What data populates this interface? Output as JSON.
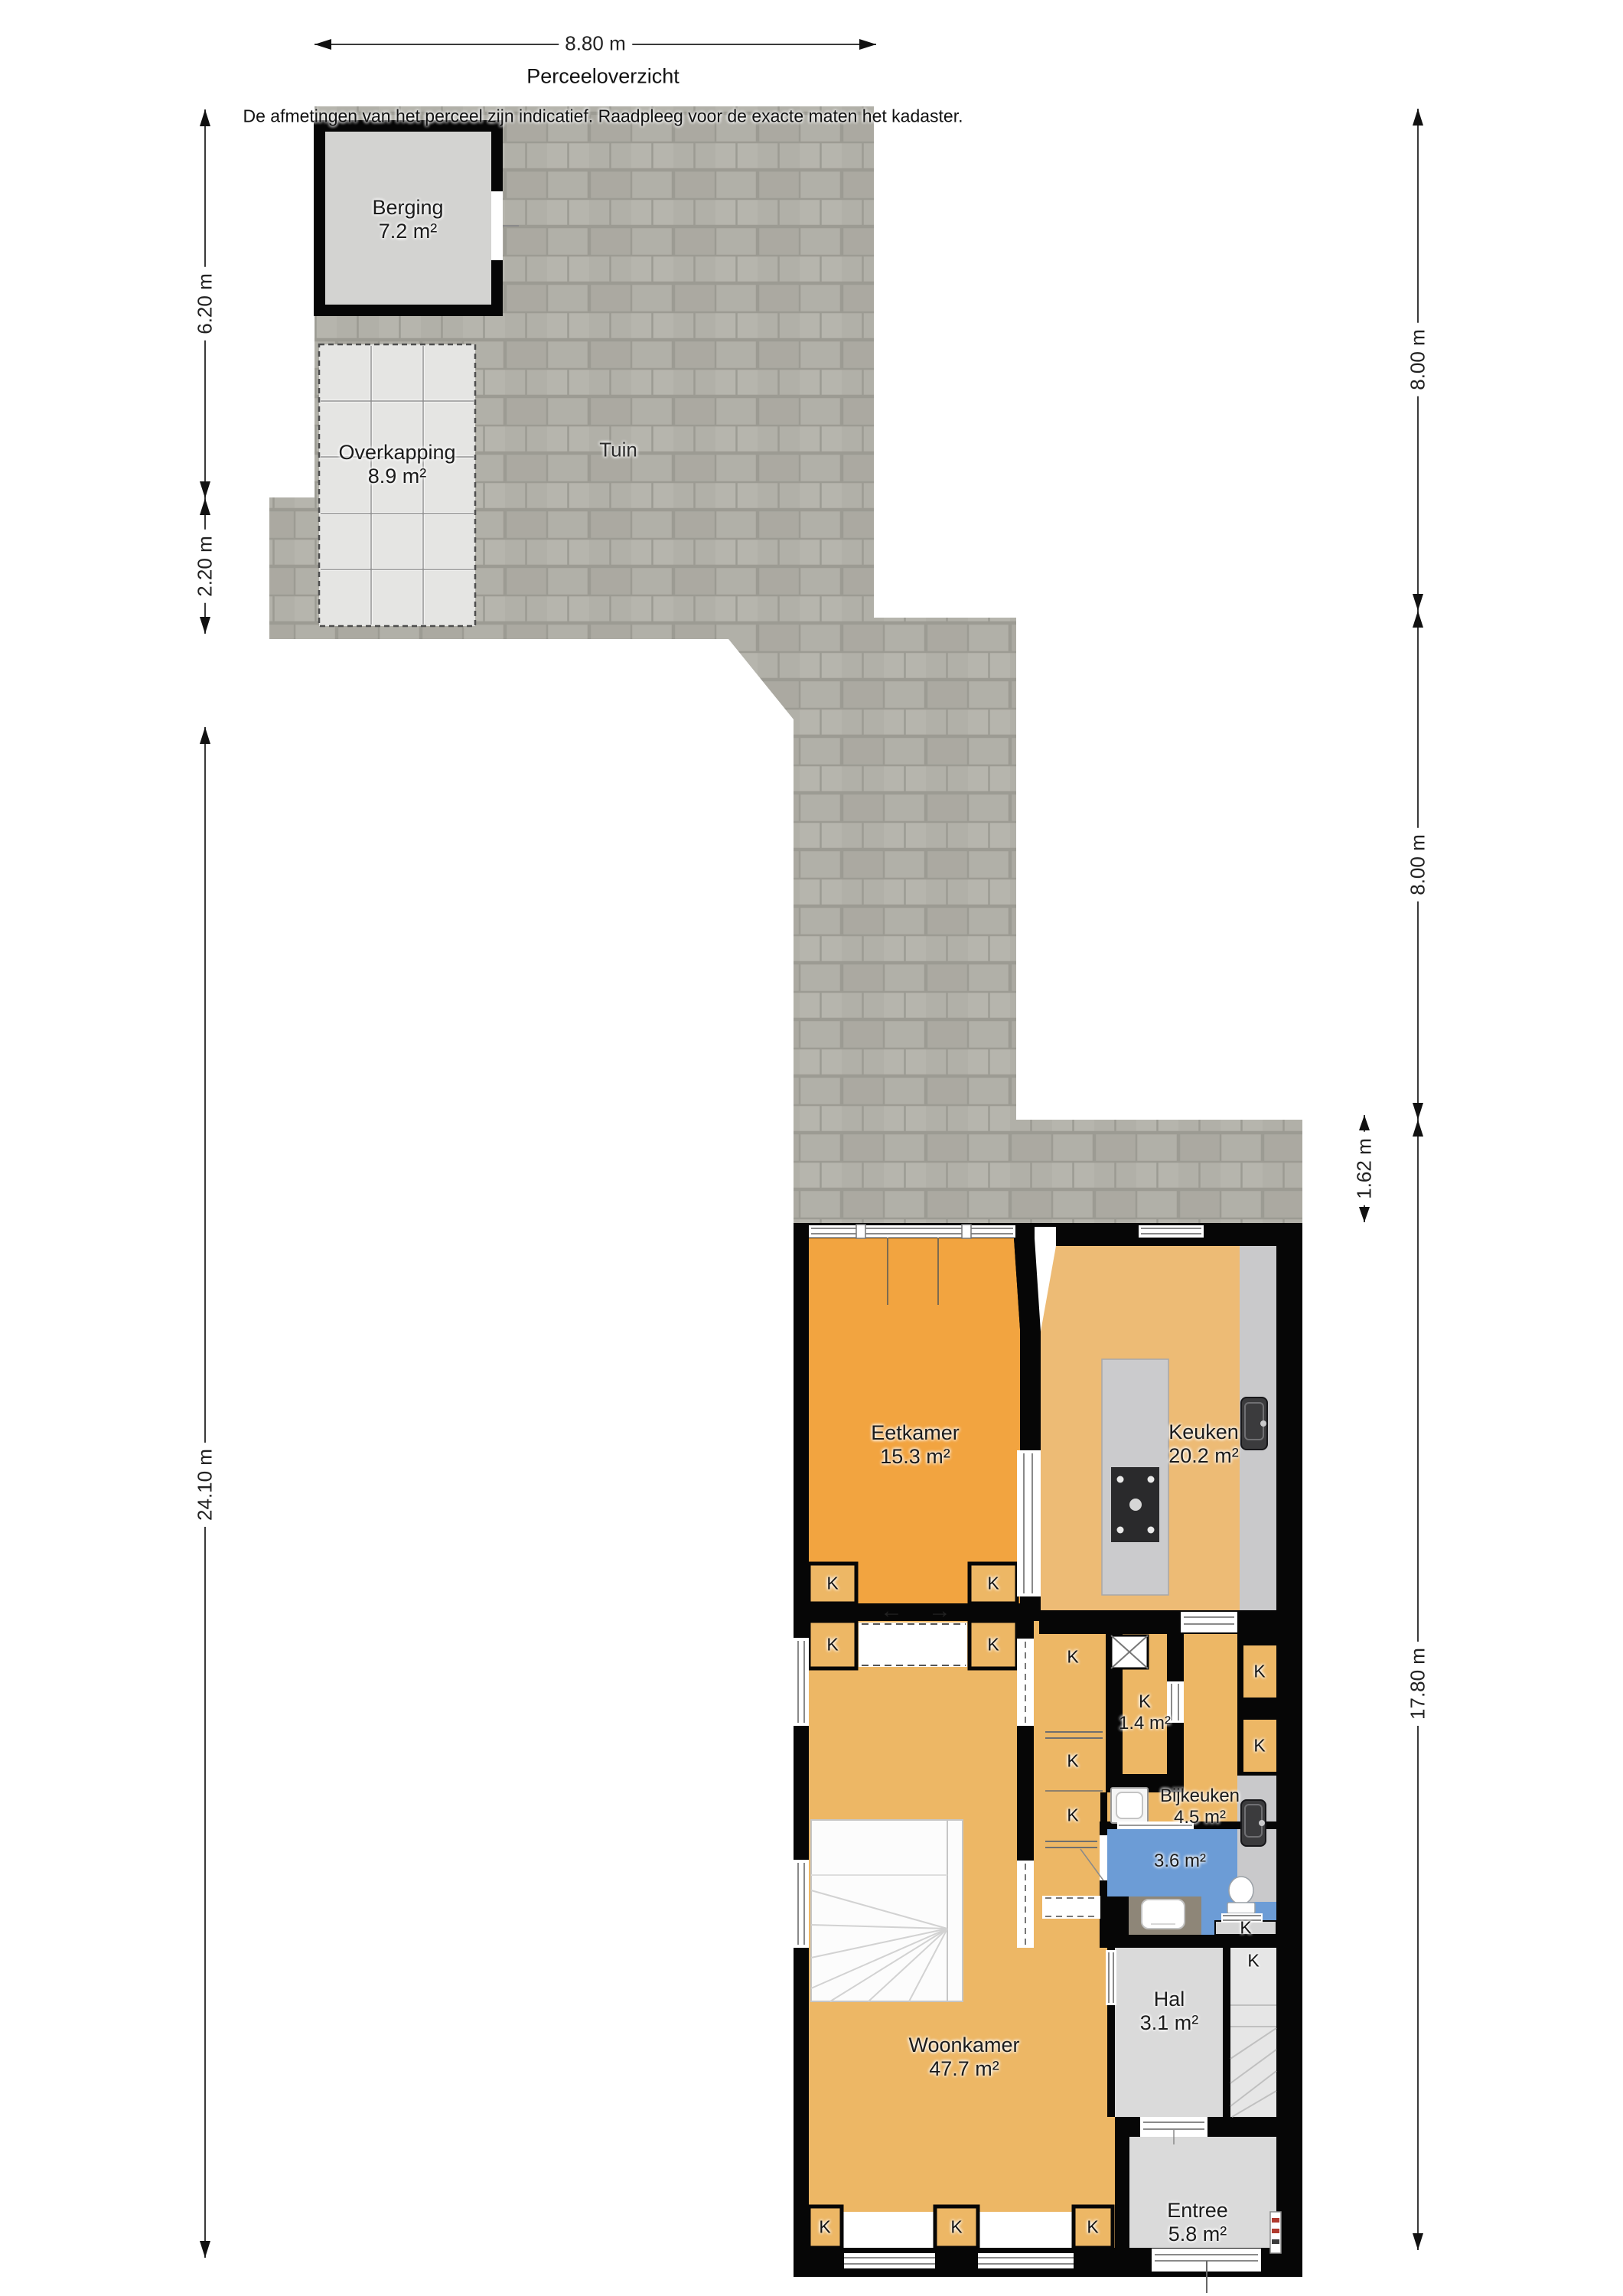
{
  "header": {
    "dimension_top": "8.80 m",
    "title": "Perceeloverzicht",
    "disclaimer": "De afmetingen van het perceel zijn indicatief. Raadpleeg voor de exacte maten het kadaster."
  },
  "dimensions": {
    "left_upper": "6.20 m",
    "left_lower": "2.20 m",
    "left_total": "24.10 m",
    "right_upper": "8.00 m",
    "right_middle": "8.00 m",
    "right_strip": "1.62 m",
    "right_house": "17.80 m"
  },
  "garden": {
    "label": "Tuin",
    "berging_name": "Berging",
    "berging_area": "7.2 m²",
    "overkapping_name": "Overkapping",
    "overkapping_area": "8.9 m²"
  },
  "rooms": {
    "eetkamer_name": "Eetkamer",
    "eetkamer_area": "15.3 m²",
    "keuken_name": "Keuken",
    "keuken_area": "20.2 m²",
    "kast_name": "K",
    "kast_area": "1.4 m²",
    "bijkeuken_name": "Bijkeuken",
    "bijkeuken_area": "4.5 m²",
    "toilet_area": "3.6 m²",
    "hal_name": "Hal",
    "hal_area": "3.1 m²",
    "woonkamer_name": "Woonkamer",
    "woonkamer_area": "47.7 m²",
    "entree_name": "Entree",
    "entree_area": "5.8 m²"
  },
  "markers": {
    "closet": "K",
    "slide_left": "←",
    "slide_right": "→"
  },
  "colors": {
    "wall": "#060606",
    "dining_orange": "#f2a440",
    "kitchen_orange": "#edbb75",
    "living_orange": "#edb765",
    "bathroom_blue": "#6c9cd6",
    "hall_gray": "#dadada",
    "garden_gray": "#b1b0a8",
    "garden_joint": "#9c9b93",
    "counter_marble": "#c9c9cb",
    "tile_light": "#e5e5e3",
    "berging_gray": "#d3d3d1"
  }
}
